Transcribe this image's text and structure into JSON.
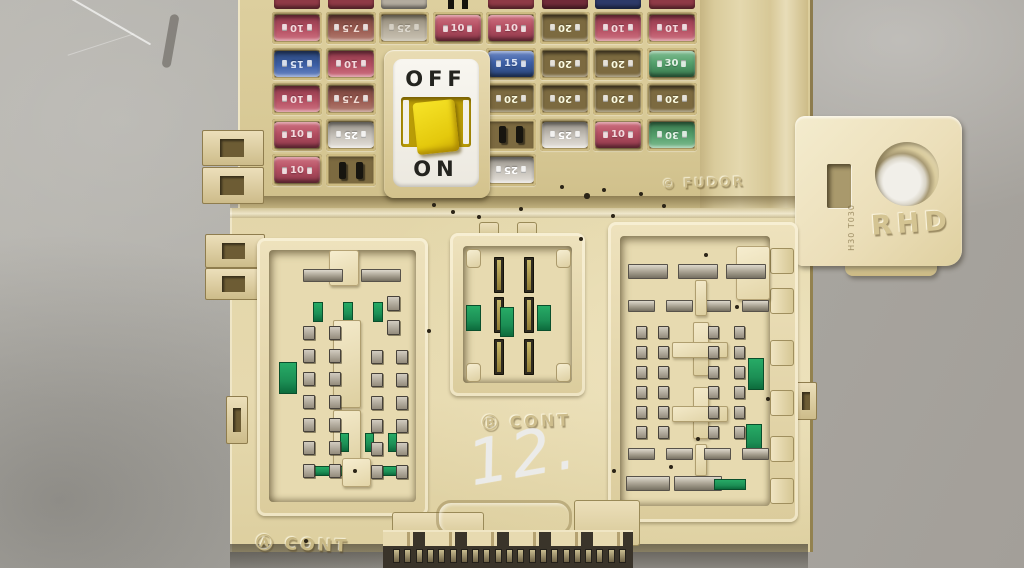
{
  "switch": {
    "off_label": "OFF",
    "on_label": "ON"
  },
  "fuse_panel": {
    "partial_top_row": [
      {
        "type": "fuse",
        "color": "darkred"
      },
      {
        "type": "fuse",
        "color": "darkred"
      },
      {
        "type": "fuse",
        "color": "silverdim"
      },
      {
        "type": "pins"
      },
      {
        "type": "fuse",
        "color": "darkred"
      },
      {
        "type": "fuse",
        "color": "maroon"
      },
      {
        "type": "fuse",
        "color": "navy"
      },
      {
        "type": "fuse",
        "color": "darkred"
      }
    ],
    "rows": [
      [
        {
          "type": "fuse",
          "label": "10",
          "color": "red",
          "rotated": true
        },
        {
          "type": "fuse",
          "label": "7.5",
          "color": "brown",
          "rotated": true
        },
        {
          "type": "fuse",
          "label": "25",
          "color": "silver",
          "rotated": true,
          "faint": true
        },
        {
          "type": "fuse",
          "label": "10",
          "color": "red"
        },
        {
          "type": "fuse",
          "label": "10",
          "color": "red"
        },
        {
          "type": "fuse",
          "label": "20",
          "color": "yellow",
          "rotated": true
        },
        {
          "type": "fuse",
          "label": "10",
          "color": "red",
          "rotated": true
        },
        {
          "type": "fuse",
          "label": "10",
          "color": "red",
          "rotated": true
        }
      ],
      [
        {
          "type": "fuse",
          "label": "15",
          "color": "blue",
          "rotated": true
        },
        {
          "type": "fuse",
          "label": "10",
          "color": "red",
          "rotated": true
        },
        {
          "type": "none"
        },
        {
          "type": "none"
        },
        {
          "type": "fuse",
          "label": "15",
          "color": "blue"
        },
        {
          "type": "fuse",
          "label": "20",
          "color": "yellow",
          "rotated": true
        },
        {
          "type": "fuse",
          "label": "20",
          "color": "yellow",
          "rotated": true
        },
        {
          "type": "fuse",
          "label": "30",
          "color": "green"
        }
      ],
      [
        {
          "type": "fuse",
          "label": "10",
          "color": "red",
          "rotated": true
        },
        {
          "type": "fuse",
          "label": "7.5",
          "color": "brown",
          "rotated": true
        },
        {
          "type": "none"
        },
        {
          "type": "none"
        },
        {
          "type": "fuse",
          "label": "20",
          "color": "yellow",
          "rotated": true
        },
        {
          "type": "fuse",
          "label": "20",
          "color": "yellow",
          "rotated": true
        },
        {
          "type": "fuse",
          "label": "20",
          "color": "yellow",
          "rotated": true
        },
        {
          "type": "fuse",
          "label": "20",
          "color": "yellow",
          "rotated": true
        }
      ],
      [
        {
          "type": "fuse",
          "label": "10",
          "color": "red"
        },
        {
          "type": "fuse",
          "label": "25",
          "color": "silver",
          "rotated": true
        },
        {
          "type": "none"
        },
        {
          "type": "none"
        },
        {
          "type": "terminals"
        },
        {
          "type": "fuse",
          "label": "25",
          "color": "silver",
          "rotated": true
        },
        {
          "type": "fuse",
          "label": "10",
          "color": "red"
        },
        {
          "type": "fuse",
          "label": "30",
          "color": "green",
          "rotated": true
        }
      ],
      [
        {
          "type": "fuse",
          "label": "10",
          "color": "red"
        },
        {
          "type": "terminals"
        },
        {
          "type": "none"
        },
        {
          "type": "none"
        },
        {
          "type": "fuse",
          "label": "25",
          "color": "silver",
          "rotated": true
        },
        {
          "type": "blank"
        },
        {
          "type": "blank"
        },
        {
          "type": "blank"
        }
      ]
    ]
  },
  "markings": {
    "rhd": "RHD",
    "tab_code": "H30 T030",
    "brand_stamp": "© FUDOR",
    "cont_b": "Ⓑ CONT",
    "cont_a": "Ⓐ CONT",
    "handwritten_number": "12."
  },
  "palette": {
    "fuse_red": "#b44f62",
    "fuse_brown": "#9a5a50",
    "fuse_blue": "#3c5fa6",
    "fuse_yellow": "#cfcb3f",
    "fuse_silver": "#c7c2ba",
    "fuse_green": "#55a06c",
    "fuse_maroon": "#702b38",
    "fuse_navy": "#2d3a68",
    "fuse_darkred": "#8f3a46",
    "fuse_silverdim": "#b3ac9f",
    "switch_yellow": "#f2d90e",
    "pcb_green": "#1c8f55",
    "box_beige": "#e6d9ae",
    "background_grey": "#aeaca6"
  }
}
